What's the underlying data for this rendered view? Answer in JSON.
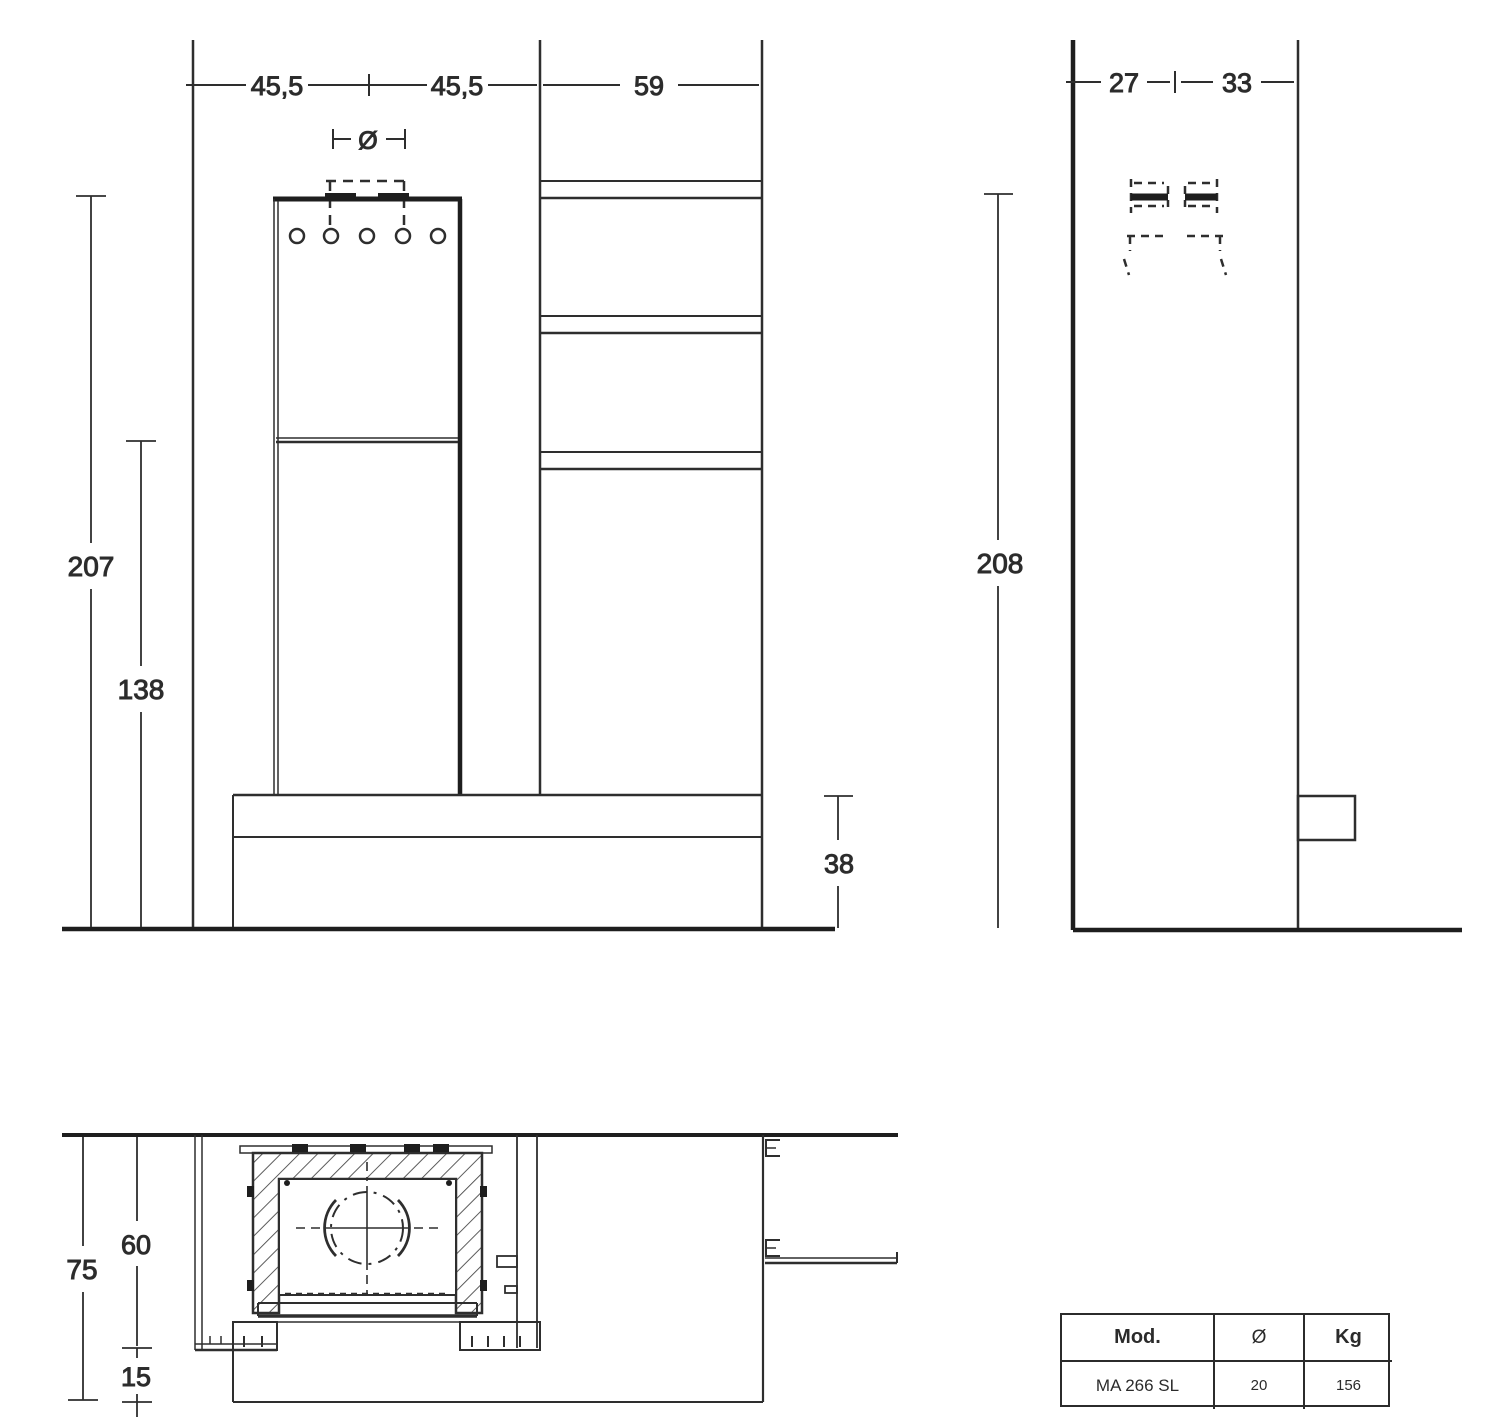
{
  "front_view": {
    "width_left": "45,5",
    "width_right": "45,5",
    "column_width": "59",
    "flue_diameter_symbol": "Ø",
    "total_height": "207",
    "firebox_top_height": "138",
    "bench_height": "38"
  },
  "side_view": {
    "depth_front": "27",
    "depth_rear": "33",
    "total_height": "208"
  },
  "plan_view": {
    "total_depth": "75",
    "recess_depth": "60",
    "bench_depth": "15"
  },
  "spec_table": {
    "headers": [
      "Mod.",
      "Ø",
      "Kg"
    ],
    "row": [
      "MA 266 SL",
      "20",
      "156"
    ]
  },
  "colors": {
    "line": "#2e2e2e",
    "line_dark": "#1e1e1e",
    "background": "#ffffff"
  }
}
